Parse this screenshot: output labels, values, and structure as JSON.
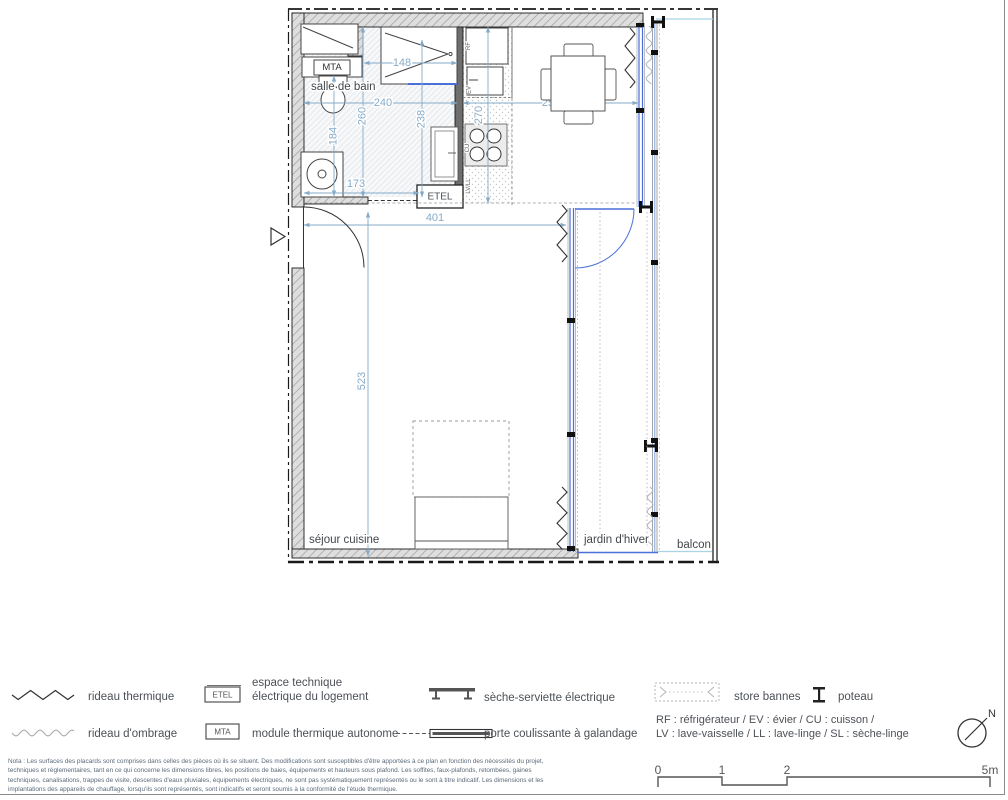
{
  "colors": {
    "dim_blue": "#86abc9",
    "glass_blue": "#4a6fd8",
    "sky_blue": "#a8d4e8"
  },
  "plan": {
    "room_labels": {
      "salle_de_bain": "salle de bain",
      "sejour_cuisine": "séjour cuisine",
      "jardin_dhiver": "jardin d'hiver",
      "balcon": "balcon"
    },
    "equipment_boxes": {
      "mta": "MTA",
      "etel": "ETEL"
    },
    "appliance_labels": {
      "rf": "RF",
      "ev": "EV",
      "cu": "CU",
      "lv_ll": "LV/LL"
    },
    "dimensions_cm": {
      "shower_width": "148",
      "bath_width": "240",
      "bath_depth_left": "260",
      "bath_depth_right": "238",
      "bath_left": "184",
      "bath_bottom": "173",
      "kitchen_depth": "270",
      "dining_width": "259",
      "hall_width": "401",
      "sejour_depth": "523"
    }
  },
  "legend": {
    "rideau_thermique": "rideau thermique",
    "rideau_ombrage": "rideau d'ombrage",
    "etel_box": "ETEL",
    "etel_desc_line1": "espace technique",
    "etel_desc_line2": "électrique du logement",
    "mta_box": "MTA",
    "mta_desc": "module thermique autonome",
    "seche_serviette": "sèche-serviette électrique",
    "porte_coulissante": "porte coulissante à galandage",
    "store_bannes": "store bannes",
    "poteau": "poteau",
    "abbr_line1": "RF : réfrigérateur / EV : évier / CU : cuisson /",
    "abbr_line2": "LV : lave-vaisselle / LL : lave-linge / SL : sèche-linge",
    "north": "N"
  },
  "scale_bar": {
    "t0": "0",
    "t1": "1",
    "t2": "2",
    "t3": "5m"
  },
  "nota": {
    "line1": "Nota : Les surfaces des placards sont comprises dans celles des pièces où ils se situent. Des modifications sont susceptibles d'être apportées à ce plan en fonction des nécessités du projet,",
    "line2": "techniques et réglementaires, tant en ce qui concerne les dimensions libres, les positions de baies, équipements et hauteurs sous plafond. Les soffites, faux-plafonds, retombées, gaines",
    "line3": "techniques, canalisations, trappes de visite, descentes d'eaux pluviales, équipements électriques, ne sont pas systématiquement représentés ou le sont à titre indicatif. Les dimensions et les",
    "line4": "implantations des appareils de chauffage, lorsqu'ils sont représentés, sont indicatifs et seront soumis à la conformité de l'étude thermique."
  }
}
